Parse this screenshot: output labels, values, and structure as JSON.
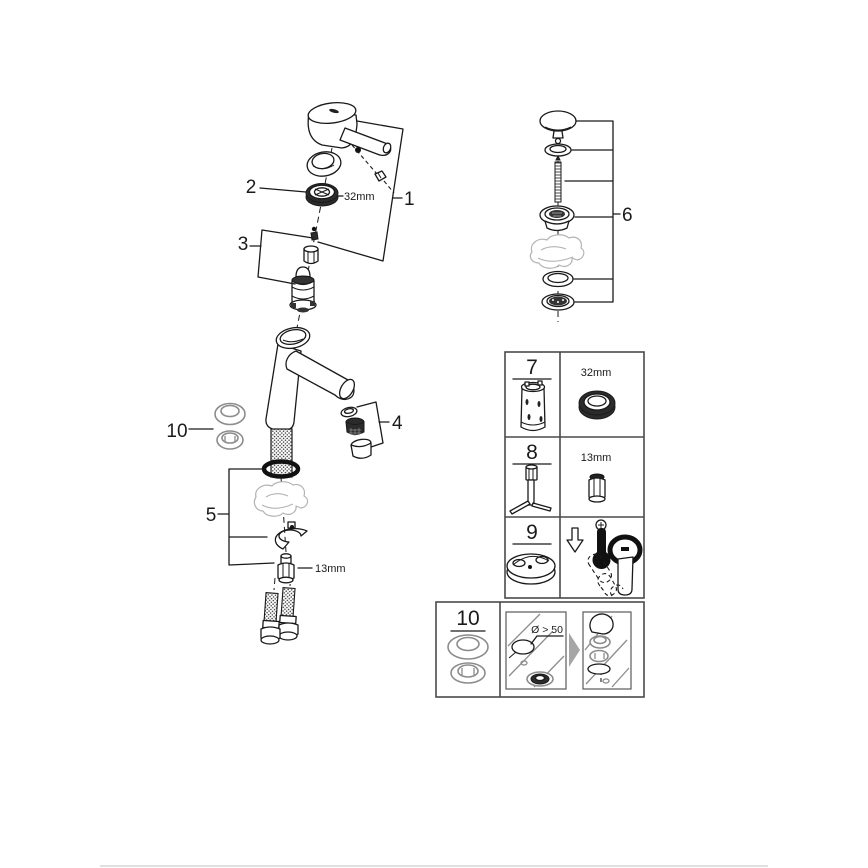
{
  "main_assembly": {
    "callout_1": "1",
    "callout_2": "2",
    "callout_3": "3",
    "callout_4": "4",
    "callout_5": "5",
    "callout_10": "10",
    "cap_nut_size_label": "32mm",
    "mounting_nut_size_label": "13mm"
  },
  "drain_assembly": {
    "callout_6": "6"
  },
  "parts_table": {
    "rows": [
      {
        "number": "7",
        "size_label": "32mm",
        "left_item_icon": "cartridge-socket-tool",
        "right_item_icon": "cap-nut-32mm"
      },
      {
        "number": "8",
        "size_label": "13mm",
        "left_item_icon": "t-socket-wrench",
        "right_item_icon": "mounting-nut-13mm"
      },
      {
        "number": "9",
        "size_label": "",
        "left_item_icon": "mounting-base",
        "right_item_icon": "cool-down-thermometer-and-lever-hand"
      }
    ]
  },
  "installation_box": {
    "number": "10",
    "hole_diameter_label": "Ø > 50"
  },
  "colors": {
    "line": "#1a1a1a",
    "ghost": "#b3b3b3",
    "gray_part": "#8c8c8c",
    "table_border": "#4a4a4a",
    "bottom_divider": "#e0e0e0",
    "background": "#ffffff"
  }
}
